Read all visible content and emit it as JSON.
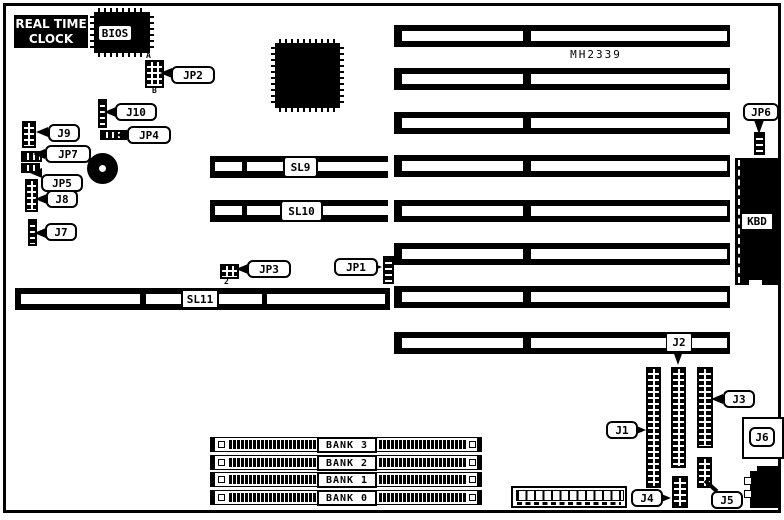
{
  "board": {
    "chip_text": "MH2339",
    "rtc_line1": "REAL TIME",
    "rtc_line2": "CLOCK",
    "bios": "BIOS",
    "kbd": "KBD",
    "marker_a": "A",
    "marker_b": "B",
    "marker_2": "2",
    "labels": {
      "jp1": "JP1",
      "jp2": "JP2",
      "jp3": "JP3",
      "jp4": "JP4",
      "jp5": "JP5",
      "jp6": "JP6",
      "jp7": "JP7",
      "j1": "J1",
      "j2": "J2",
      "j3": "J3",
      "j4": "J4",
      "j5": "J5",
      "j6": "J6",
      "j7": "J7",
      "j8": "J8",
      "j9": "J9",
      "j10": "J10"
    },
    "slots": {
      "sl9": "SL9",
      "sl10": "SL10",
      "sl11": "SL11"
    },
    "banks": [
      "BANK 3",
      "BANK 2",
      "BANK 1",
      "BANK 0"
    ],
    "colors": {
      "ink": "#000000",
      "paper": "#ffffff"
    }
  }
}
